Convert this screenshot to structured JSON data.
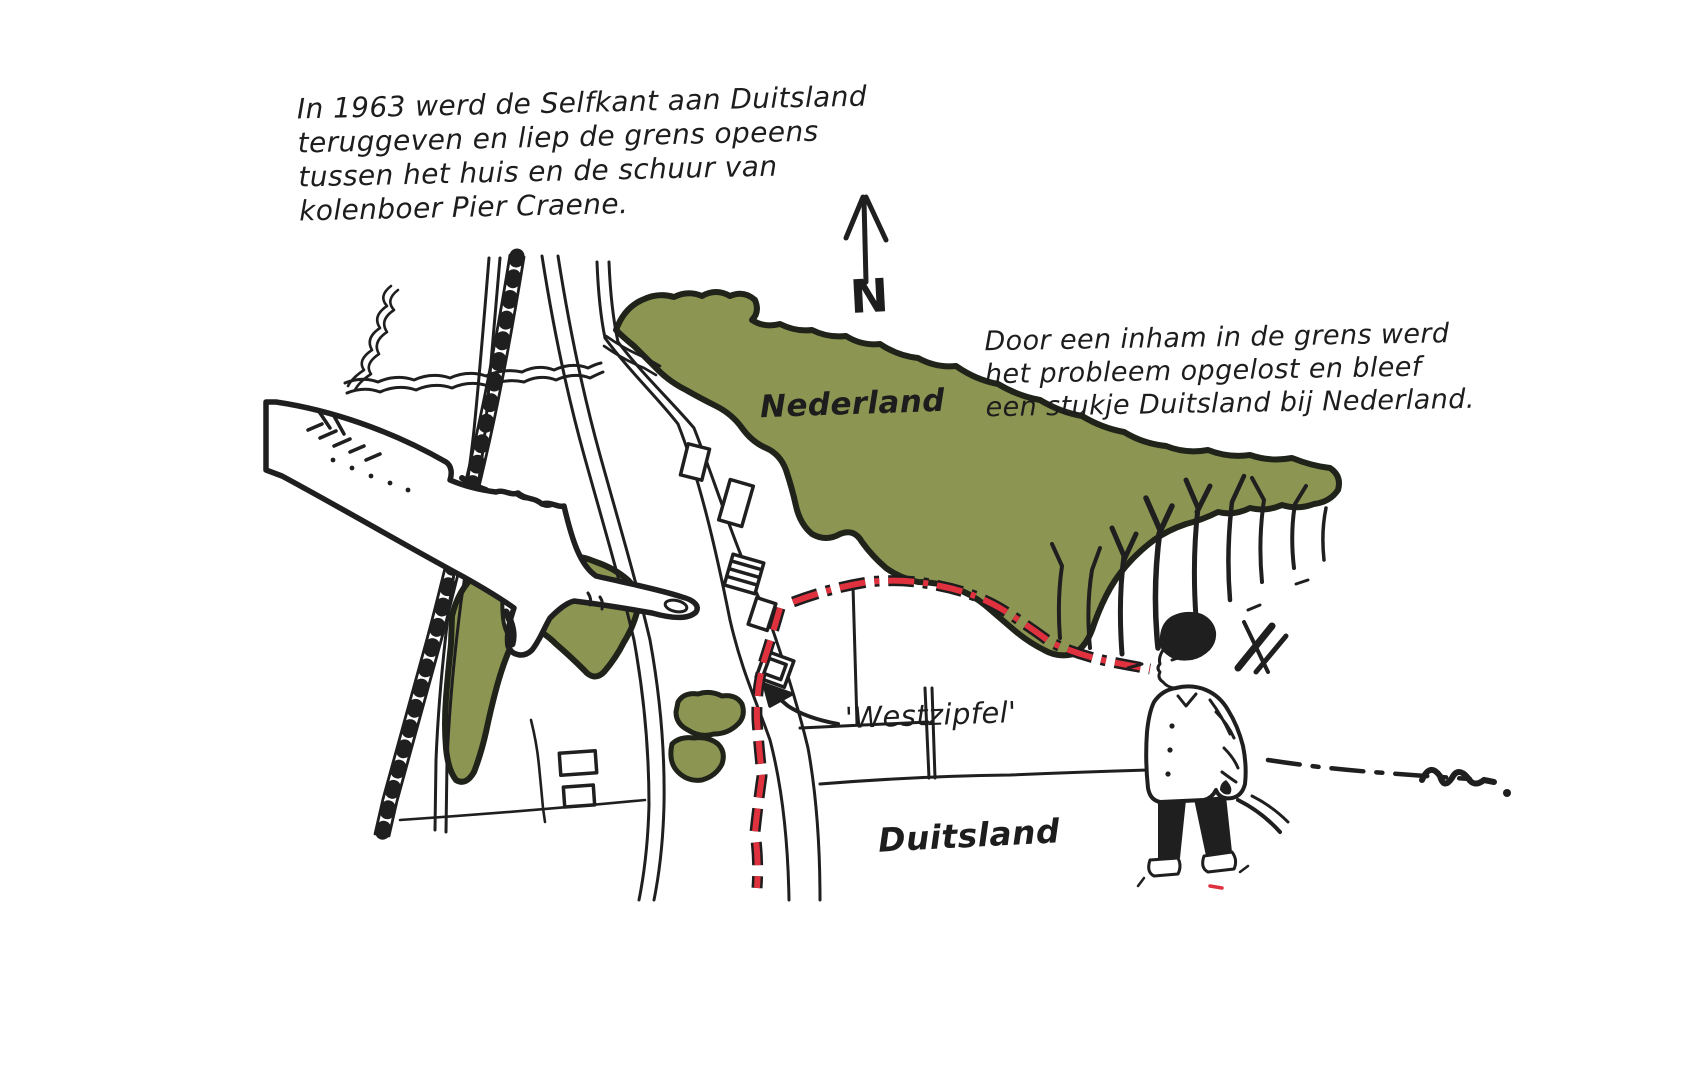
{
  "illustration": {
    "caption_top_left": {
      "line1": "In 1963 werd de Selfkant aan Duitsland",
      "line2": "teruggeven en liep de grens opeens",
      "line3": "tussen het huis en de schuur van",
      "line4": "kolenboer Pier Craene."
    },
    "caption_right": {
      "line1": "Door een inham in de grens werd",
      "line2": "het probleem opgelost en bleef",
      "line3": "een stukje Duitsland bij Nederland."
    },
    "labels": {
      "country_north": "Nederland",
      "country_south": "Duitsland",
      "border_area": "'Westzipfel'",
      "compass_north": "N"
    },
    "colors": {
      "forest_green": "#8c9552",
      "border_red": "#e0323e",
      "ink": "#1f1f1f",
      "background": "#ffffff"
    }
  }
}
